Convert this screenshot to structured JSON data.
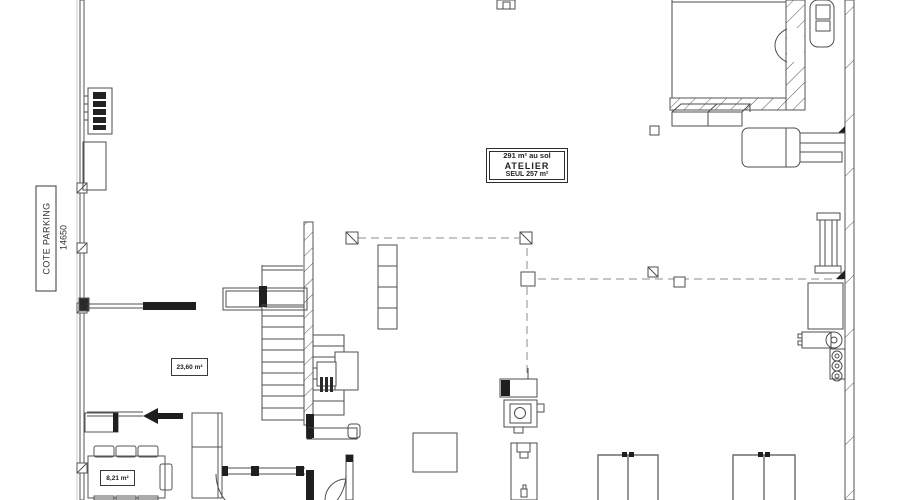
{
  "drawing": {
    "side_label": "COTE PARKING",
    "side_dimension": "14650",
    "atelier_box": {
      "line1": "291 m² au sol",
      "line2": "ATELIER",
      "line3": "SEUL 257 m²"
    },
    "room_areas": [
      {
        "id": "mezzanine-room",
        "label": "23,60 m²"
      },
      {
        "id": "table-room",
        "label": "8,21 m²"
      }
    ]
  },
  "colors": {
    "background": "#ffffff",
    "line": "#4d4d4d",
    "line_dark": "#1f1f1f",
    "dashed": "#8c8c8c",
    "boundary": "#c9c9c9"
  }
}
